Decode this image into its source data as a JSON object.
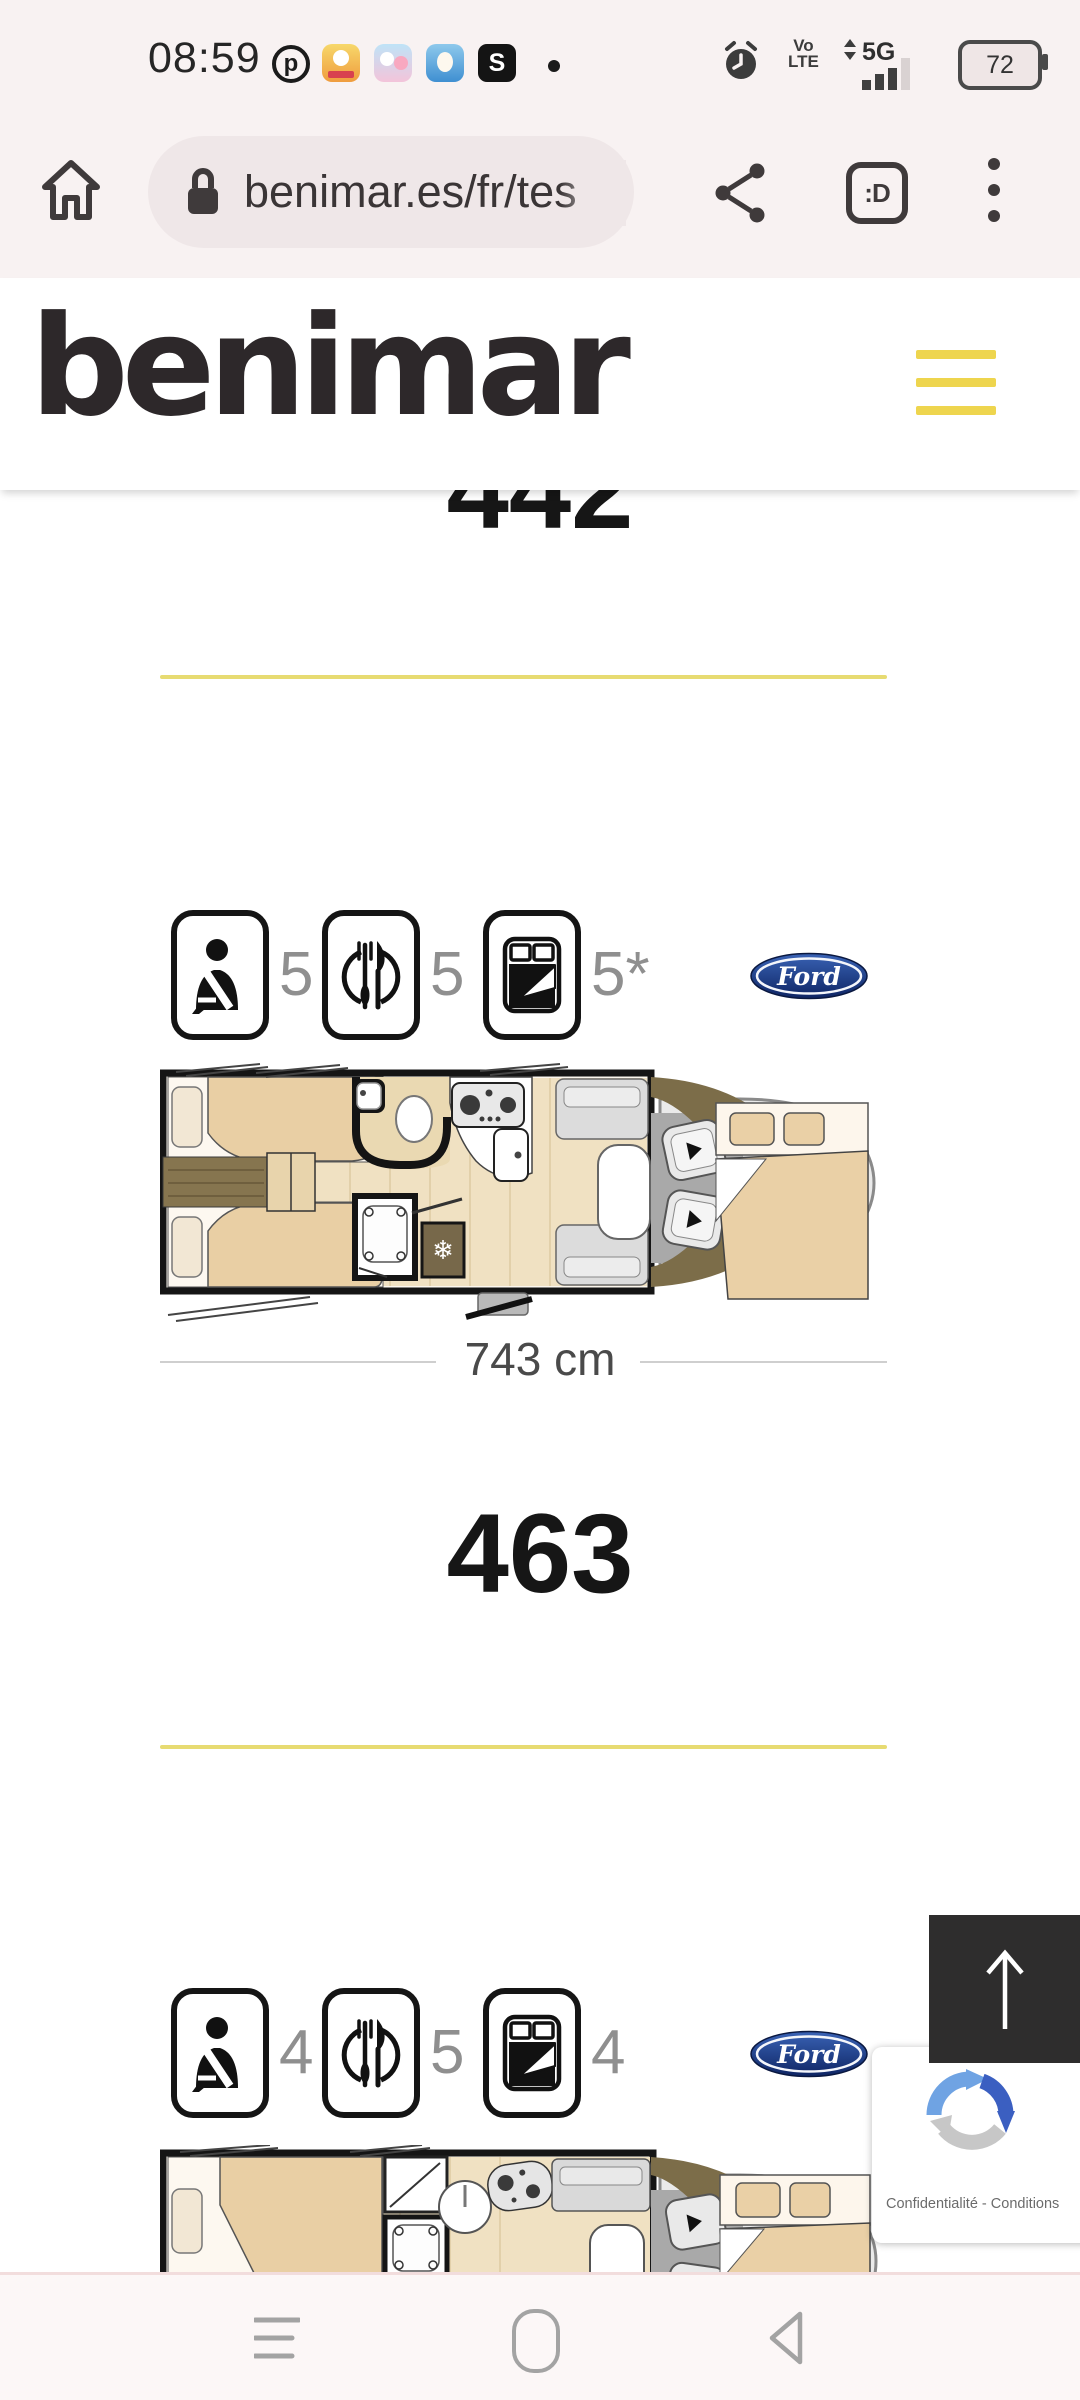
{
  "status": {
    "time": "08:59",
    "pinterest_glyph": "p",
    "s_badge": "S",
    "volte_top": "Vo",
    "volte_bottom": "LTE",
    "network": "5G",
    "battery_percent": "72"
  },
  "browser": {
    "url": "benimar.es/fr/tes",
    "tab_badge": ":D"
  },
  "site": {
    "brand": "benimar"
  },
  "models": [
    {
      "name": "442",
      "belted_seats": "5",
      "dining_seats": "5",
      "sleeping_places": "5*",
      "length": "743 cm",
      "chassis": "Ford"
    },
    {
      "name": "463",
      "belted_seats": "4",
      "dining_seats": "5",
      "sleeping_places": "4",
      "chassis": "Ford"
    }
  ],
  "recaptcha": {
    "label": "Confidentialité - Conditions"
  }
}
